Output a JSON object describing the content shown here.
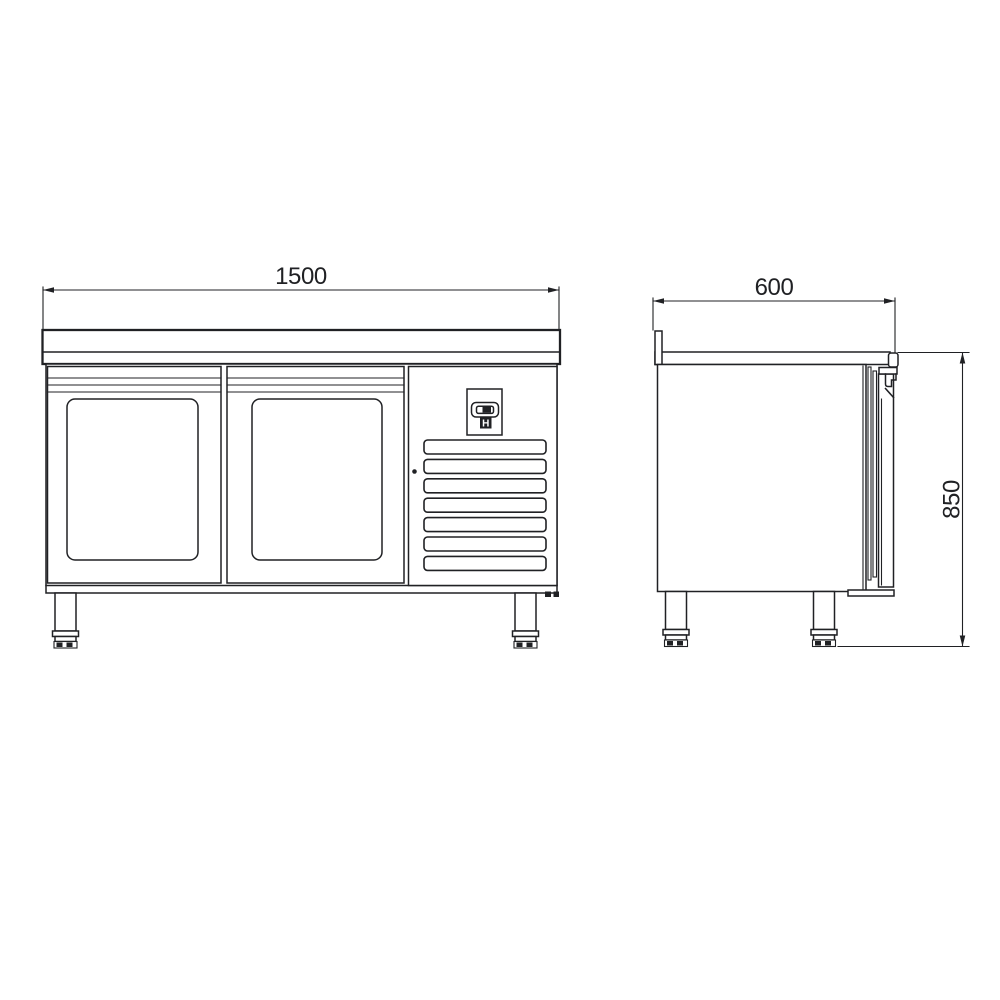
{
  "colors": {
    "background": "#ffffff",
    "line": "#202124"
  },
  "front_view": {
    "width_dimension": "1500",
    "door_count": 2,
    "vent_grille": {
      "slat_count": 7
    },
    "control_panel": {
      "label": "H"
    }
  },
  "side_view": {
    "depth_dimension": "600",
    "height_dimension": "850"
  }
}
